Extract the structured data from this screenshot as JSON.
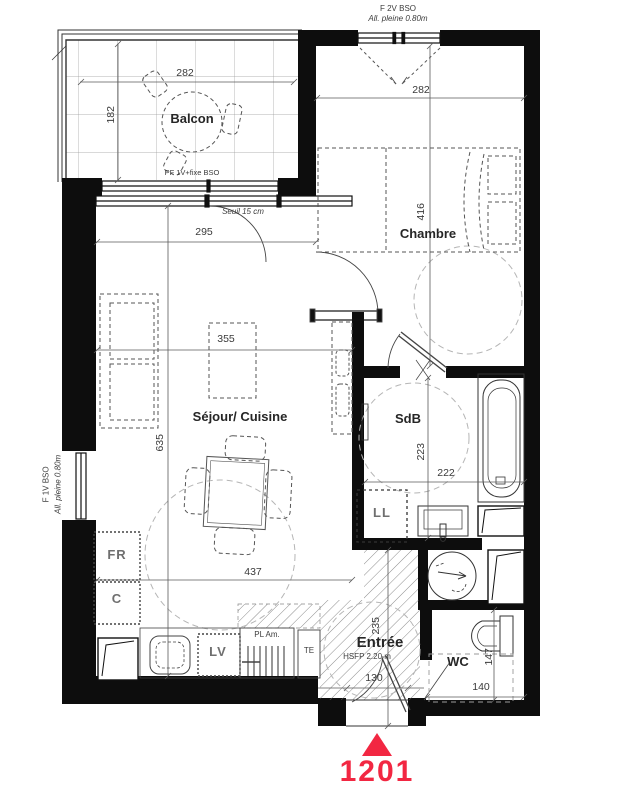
{
  "unit": {
    "number": "1201"
  },
  "colors": {
    "accent": "#F22742",
    "wall": "#0d0d0d"
  },
  "rooms": {
    "balcon": "Balcon",
    "chambre": "Chambre",
    "sejour": "Séjour/ Cuisine",
    "sdb": "SdB",
    "entree": "Entrée",
    "wc": "WC"
  },
  "labels": {
    "windows": {
      "top1": "F 2V BSO",
      "top2": "All. pleine 0.80m",
      "left1": "F 1V BSO",
      "left2": "All. pleine 0.80m",
      "balcony": "PF 1V+fixe BSO"
    }
  },
  "notes": {
    "seuil": "Seuil 15 cm",
    "hsfp": "HSFP 2.20 m"
  },
  "appliances": {
    "fr": "FR",
    "c": "C",
    "lv": "LV",
    "ll": "LL",
    "pl": "PL Am.",
    "te": "TE"
  },
  "dims": {
    "balcon_w": "282",
    "balcon_d": "182",
    "chambre_w": "282",
    "chambre_d": "416",
    "sejour_w295": "295",
    "sejour_w355": "355",
    "sejour_h635": "635",
    "sejour_w437": "437",
    "sdb_d": "223",
    "sdb_w": "222",
    "entree_d": "235",
    "entree_w": "130",
    "wc_d": "147",
    "wc_w": "140"
  }
}
